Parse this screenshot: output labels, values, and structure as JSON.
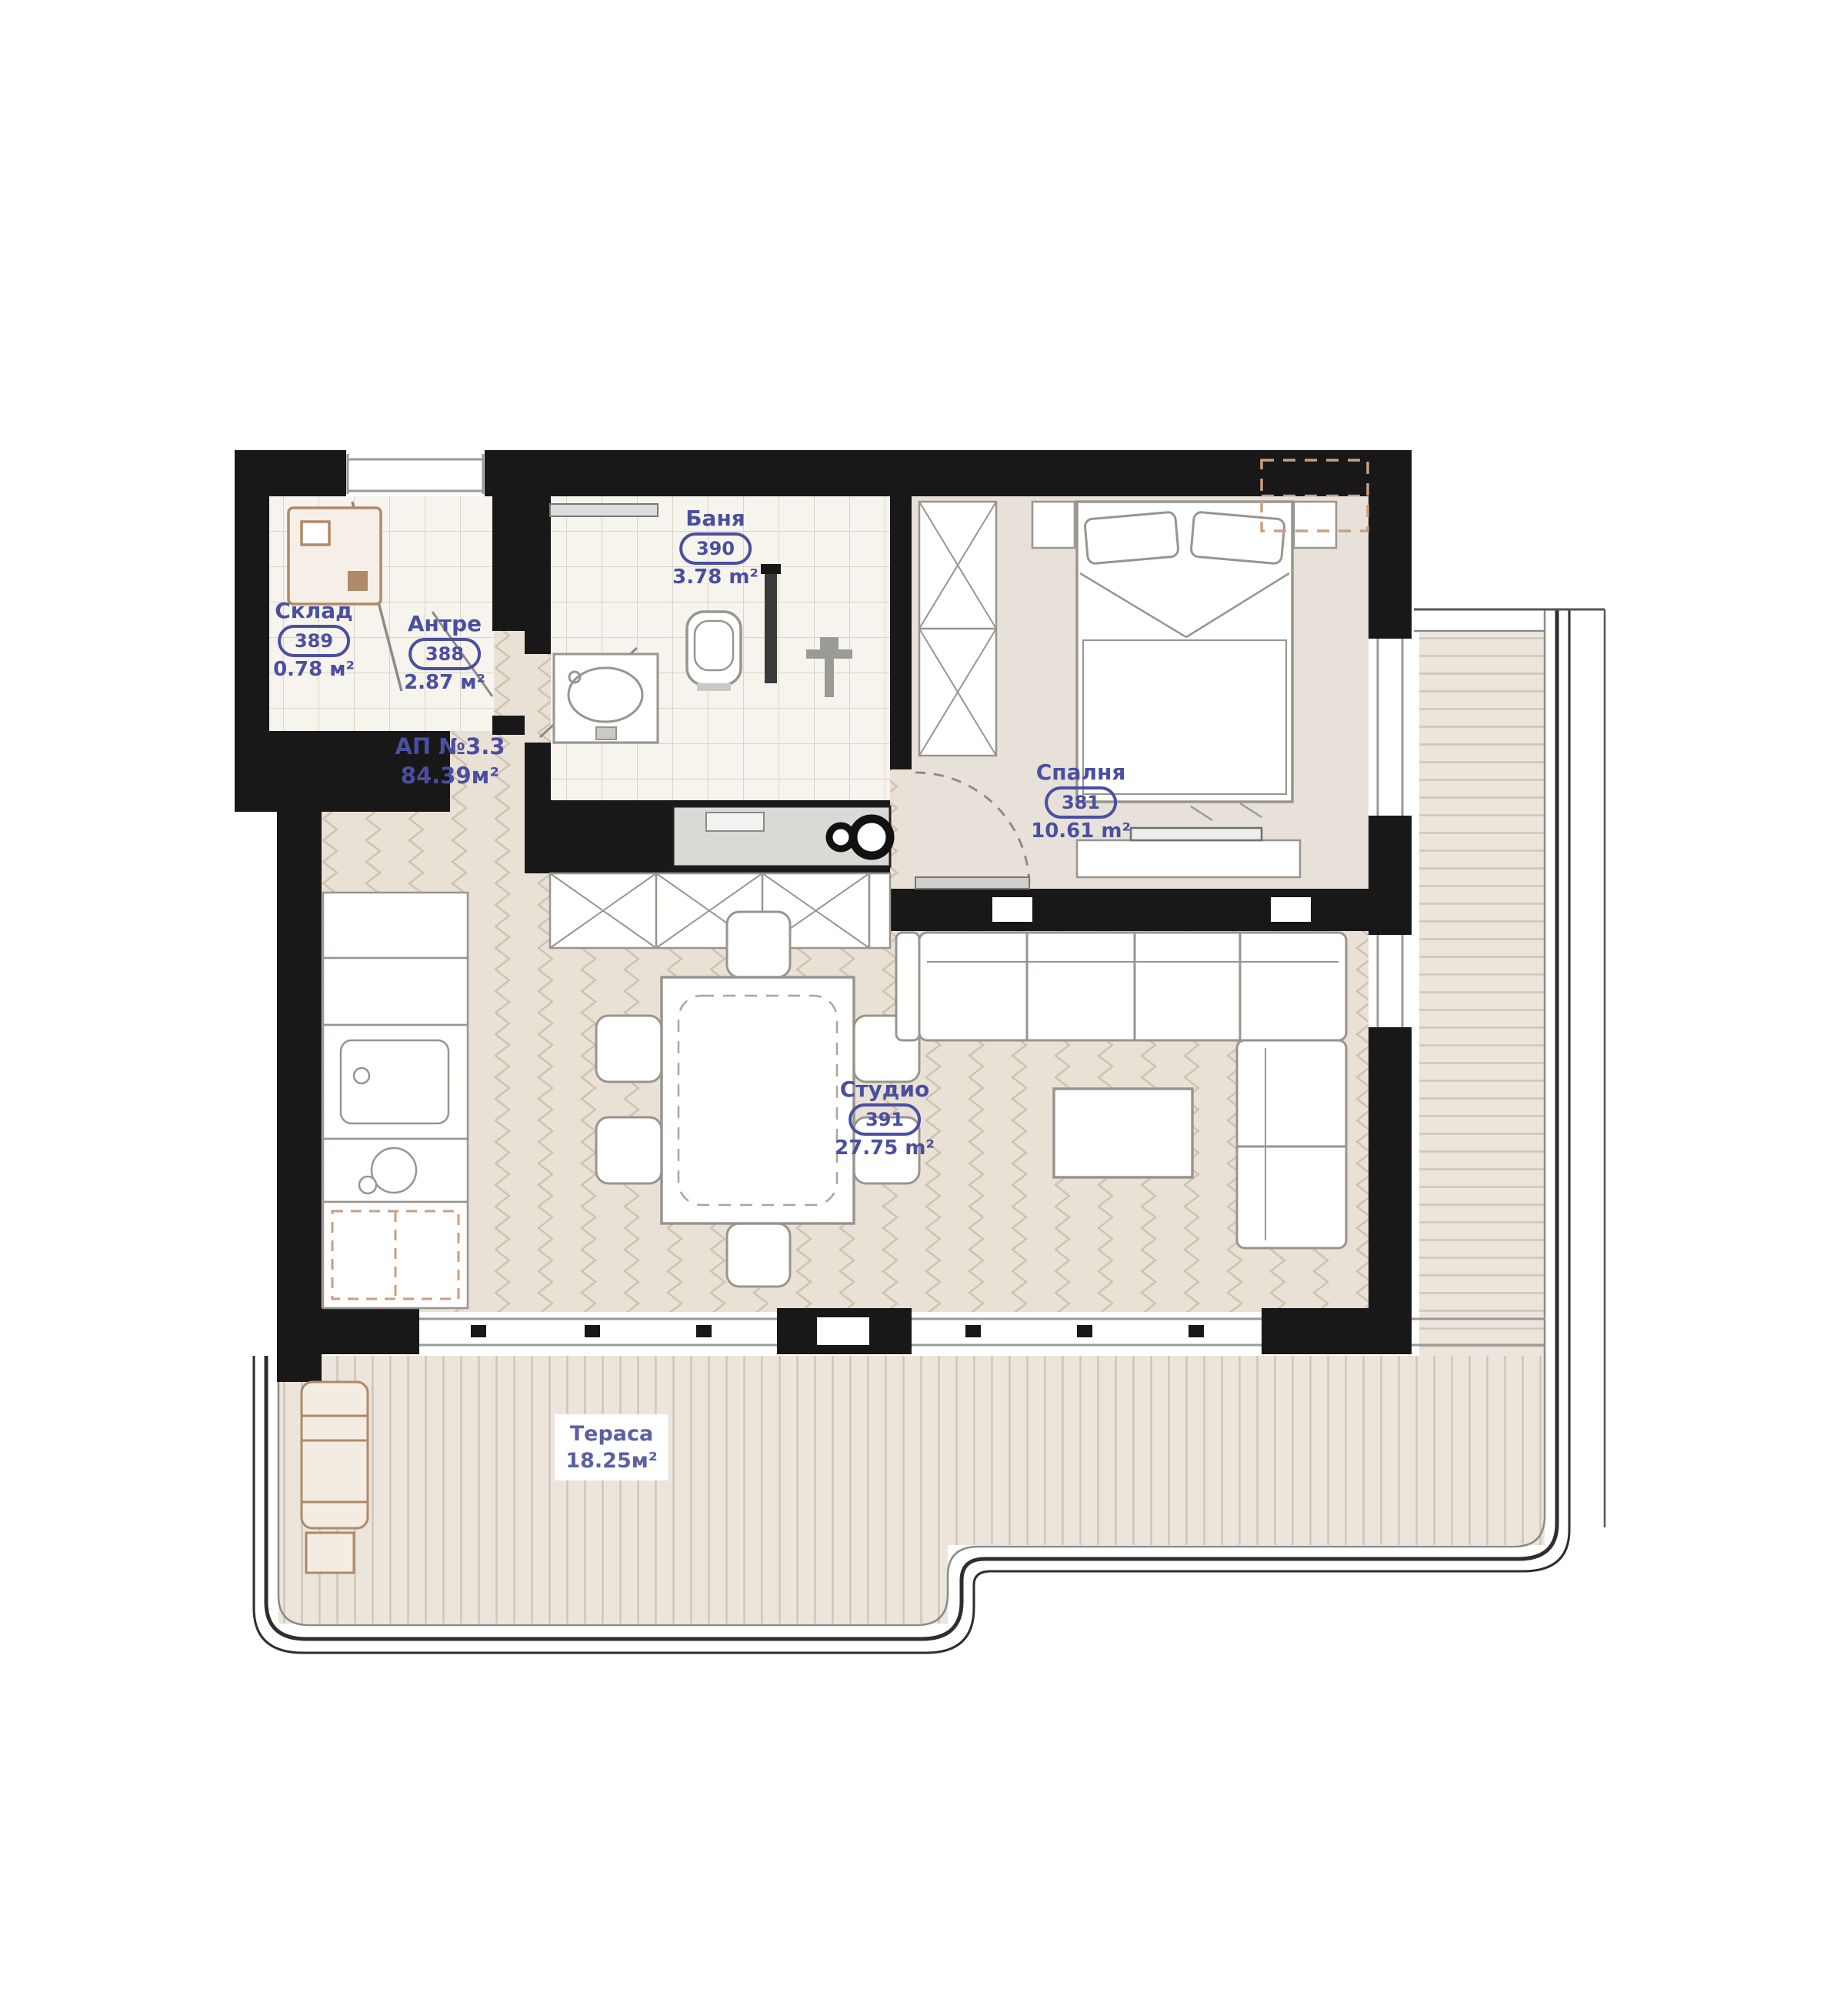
{
  "floorplan": {
    "apartment": {
      "name": "АП №3.3",
      "area": "84.39м²"
    },
    "rooms": {
      "sklad": {
        "name": "Склад",
        "number": "389",
        "area": "0.78 м²"
      },
      "antre": {
        "name": "Антре",
        "number": "388",
        "area": "2.87 м²"
      },
      "banya": {
        "name": "Баня",
        "number": "390",
        "area": "3.78 m²"
      },
      "spalnya": {
        "name": "Спалня",
        "number": "381",
        "area": "10.61 m²"
      },
      "studio": {
        "name": "Студио",
        "number": "391",
        "area": "27.75 m²"
      }
    },
    "terrace": {
      "name": "Тераса",
      "area": "18.25м²"
    },
    "colors": {
      "wall": "#181818",
      "label": "#4a4fa0",
      "wood_floor": "#eae1d6",
      "tile_floor": "#f7f4ee",
      "bedroom_floor": "#e7e1d9",
      "deck_floor": "#ece5db",
      "accent_tan": "#b08968",
      "counter_gray": "#d9d9d6"
    }
  }
}
